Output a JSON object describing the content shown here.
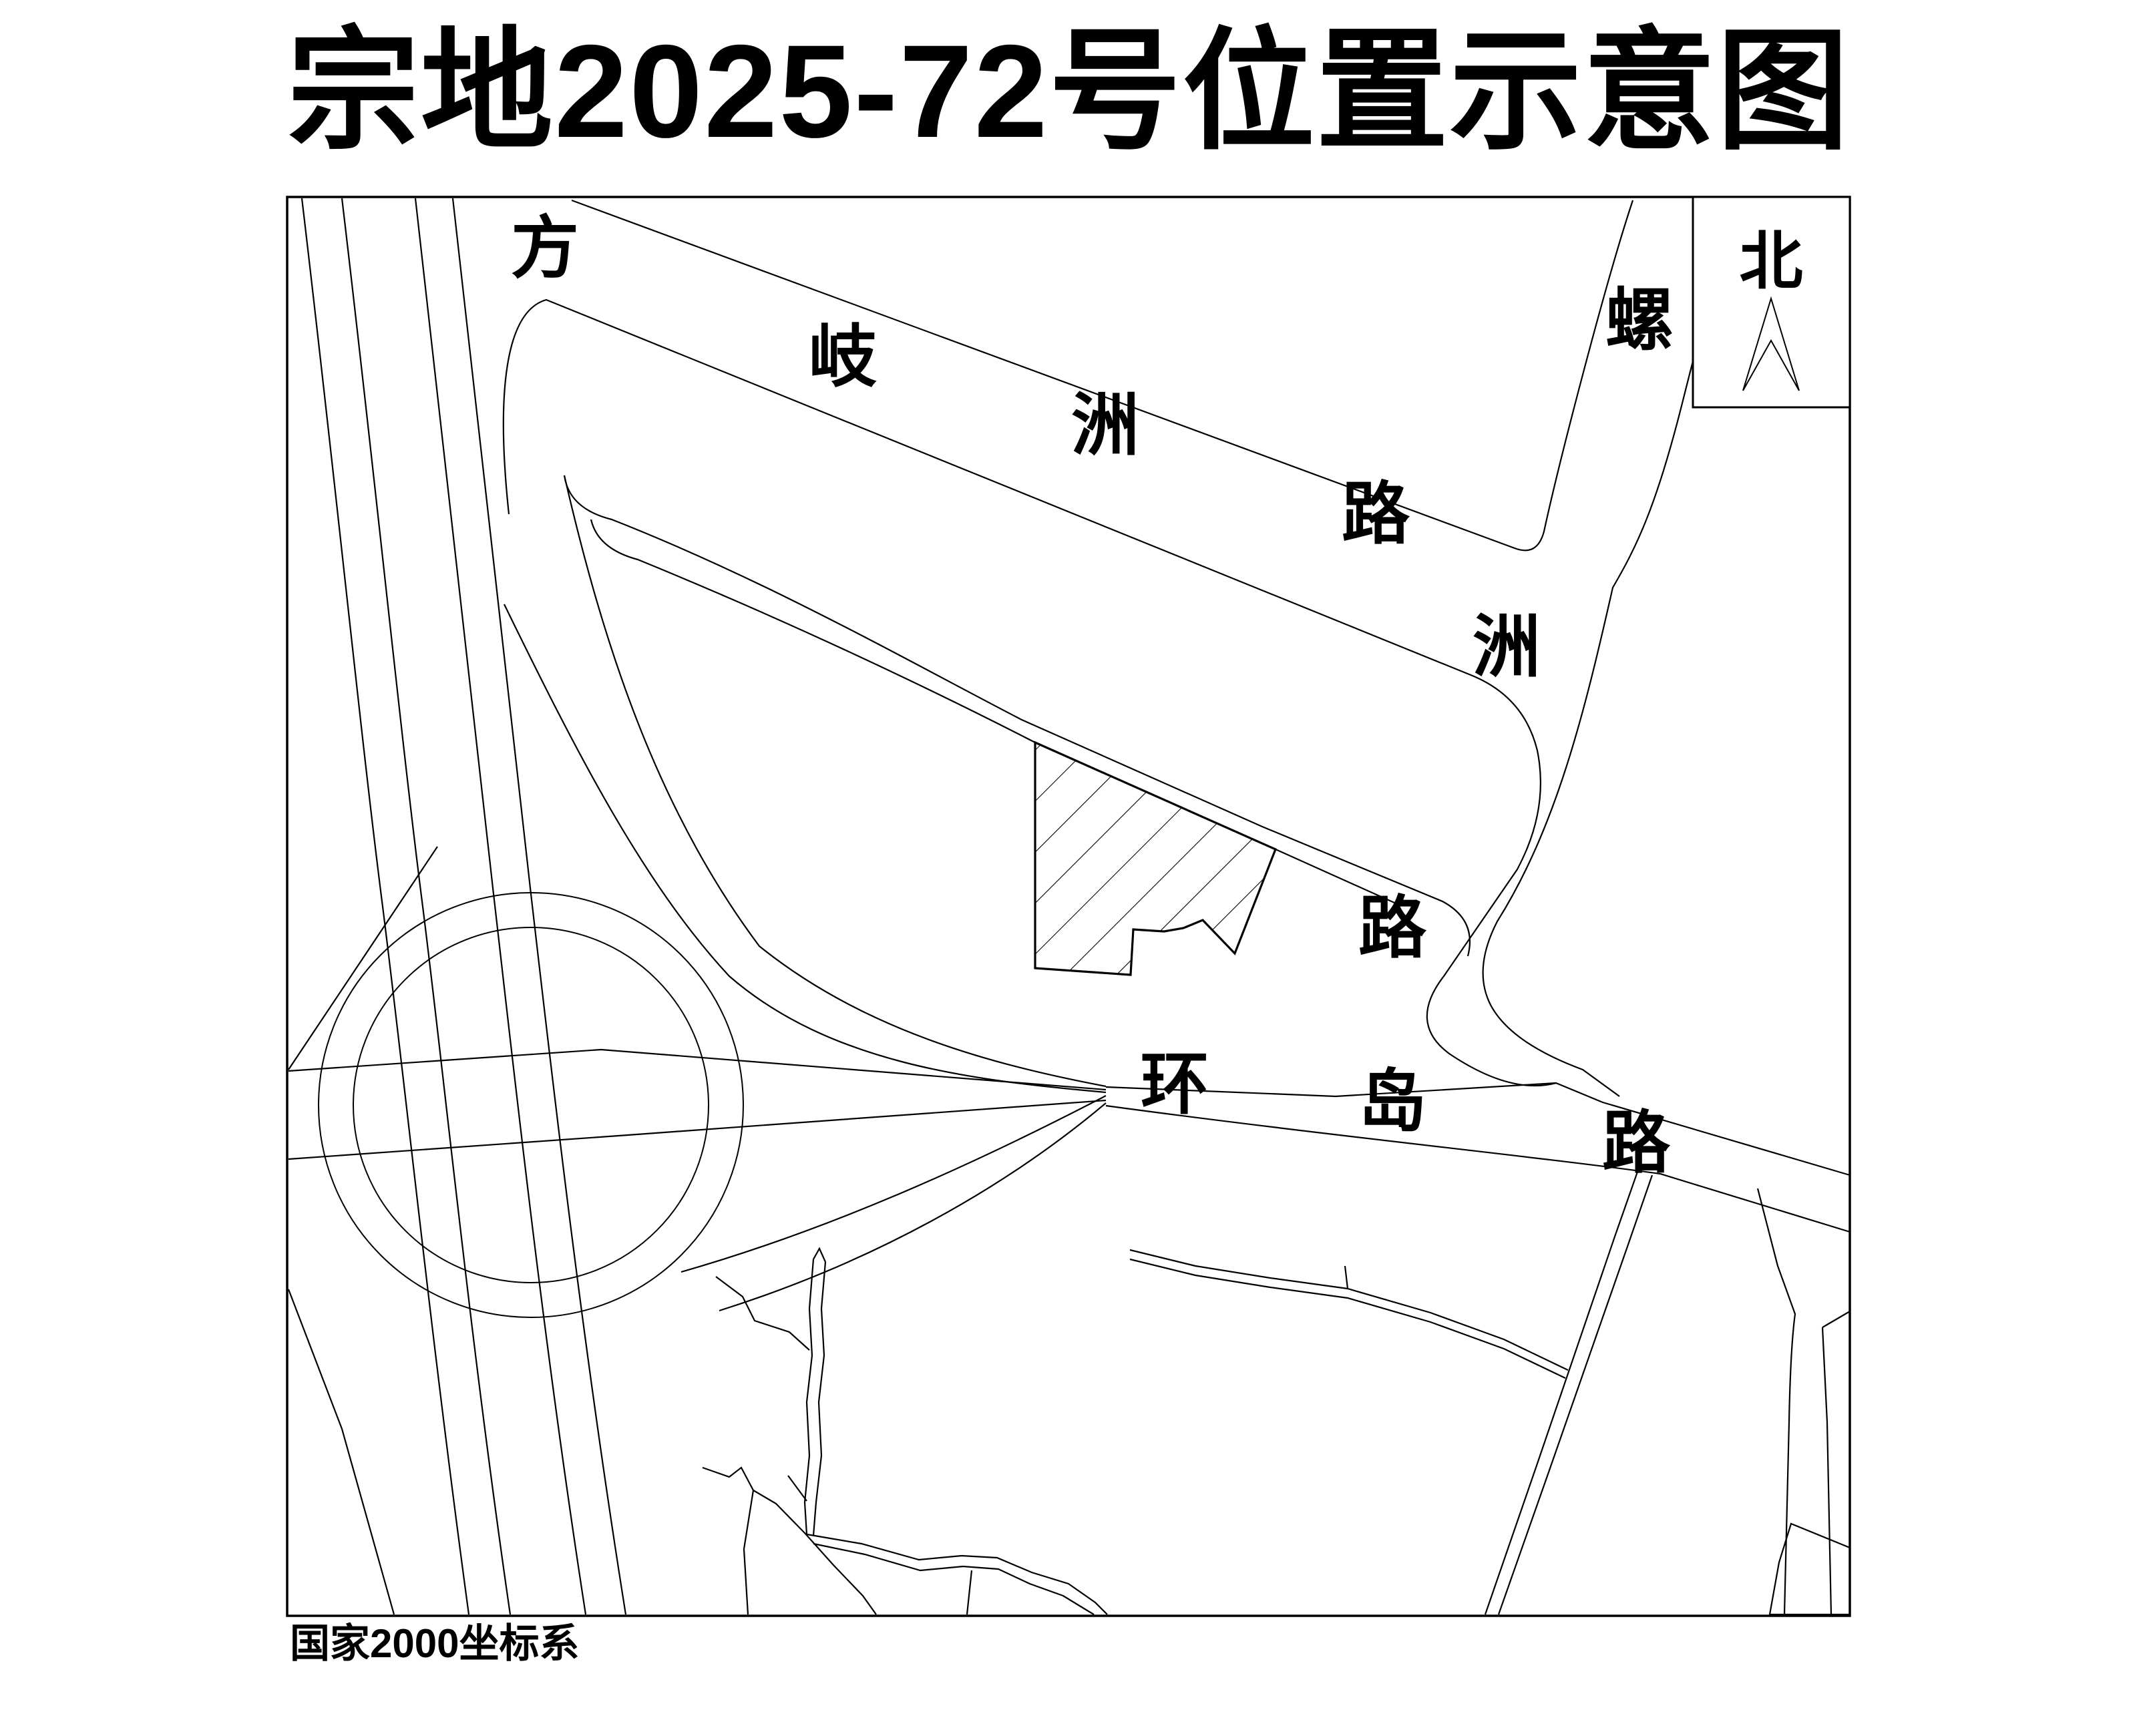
{
  "title": "宗地2025-72号位置示意图",
  "compass": {
    "label": "北"
  },
  "footnote": "国家2000坐标系",
  "roads": [
    {
      "name": "方岐洲路",
      "chars": [
        "方",
        "岐",
        "洲",
        "路"
      ]
    },
    {
      "name": "螺洲路",
      "chars": [
        "螺",
        "洲",
        "路"
      ]
    },
    {
      "name": "环岛路",
      "chars": [
        "环",
        "岛",
        "路"
      ]
    }
  ],
  "parcel": {
    "fill_style": "diagonal-hatch",
    "outline_color": "#000000"
  },
  "colors": {
    "line": "#000000",
    "background": "#ffffff"
  }
}
